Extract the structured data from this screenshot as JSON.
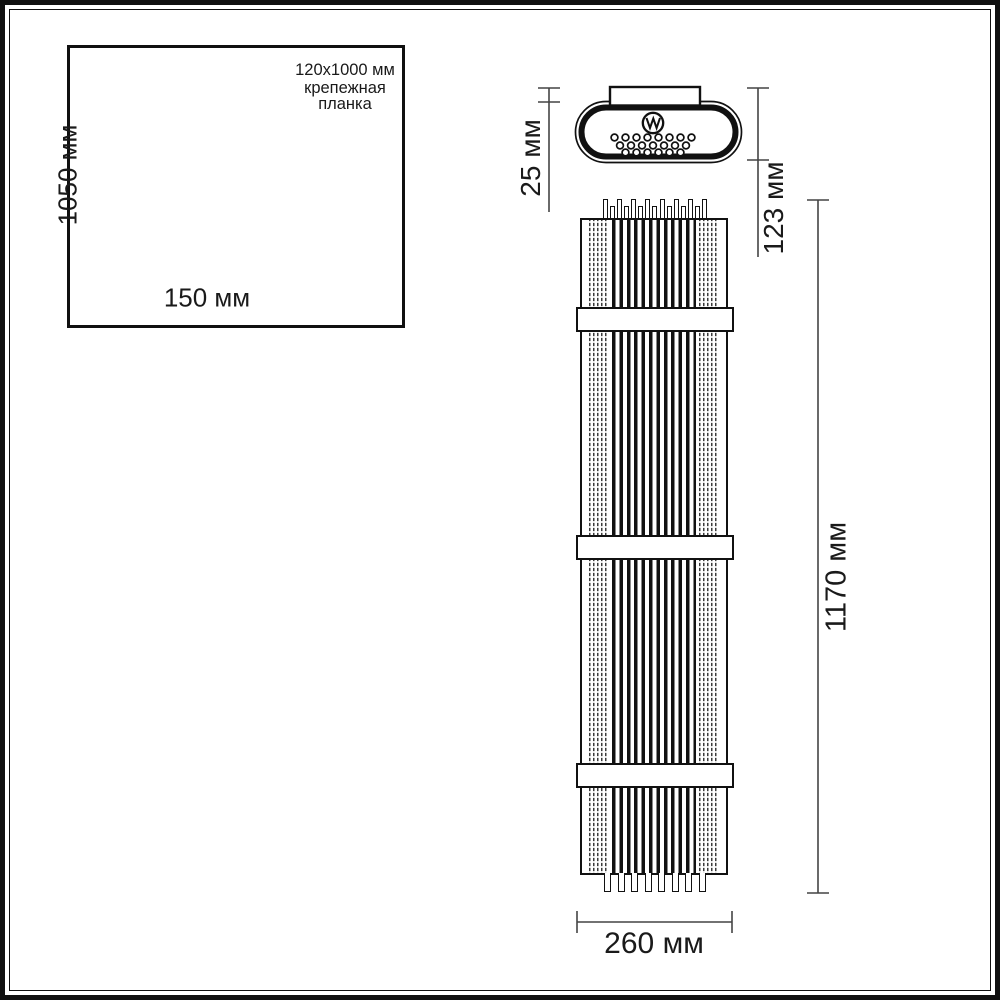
{
  "colors": {
    "ink": "#1a1a1a",
    "dimension_line": "#444444",
    "background": "#ffffff"
  },
  "mounting_inset": {
    "height_label": "1050 мм",
    "width_label": "150 мм",
    "note_line1": "120x1000 мм",
    "note_line2": "крепежная",
    "note_line3": "планка"
  },
  "top_view": {
    "plate_depth_label": "25 мм",
    "fixture_depth_label": "123 мм"
  },
  "front_view": {
    "height_label": "1170 мм",
    "width_label": "260 мм"
  }
}
